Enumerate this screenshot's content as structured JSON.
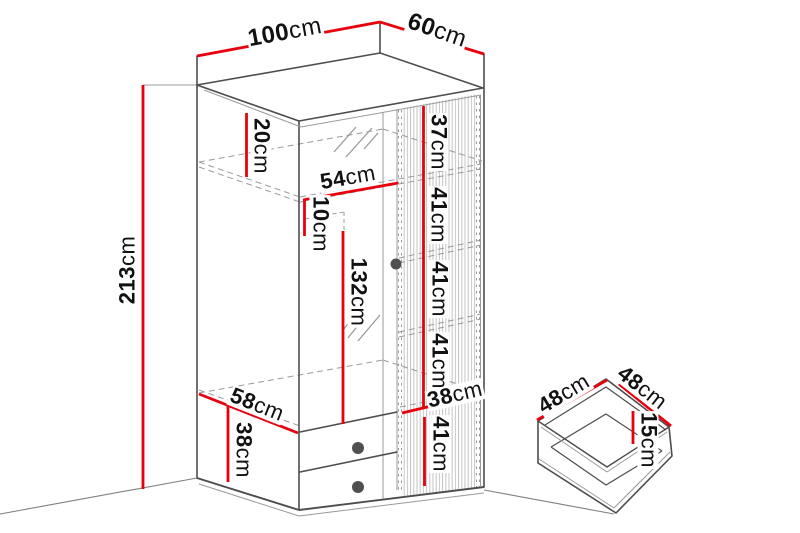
{
  "unit": "cm",
  "colors": {
    "dimension": "#e8000d",
    "outline": "#4d4d4d",
    "soft": "#9a9a9a",
    "dashed": "#999999",
    "holes": "#8f8f8f",
    "floor": "#808080",
    "slat": "#c4c4c4",
    "knob": "#4f4f4f",
    "text": "#111111"
  },
  "wardrobe": {
    "width_cm": 100,
    "depth_cm": 60,
    "height_cm": 213,
    "top_shelf_offset_cm": 20,
    "left_section_width_cm": 54,
    "rail_offset_cm": 10,
    "hanging_height_cm": 132,
    "right_shelf_spacing_cm": [
      37,
      41,
      41,
      41,
      41
    ],
    "right_section_width_cm": 38,
    "bottom_shelf_depth_cm": 58,
    "drawer_section_height_cm": 38
  },
  "drawer": {
    "width_cm": 48,
    "depth_cm": 48,
    "height_cm": 15
  },
  "labels": [
    {
      "id": "width",
      "value": "100",
      "unit": "cm"
    },
    {
      "id": "depth",
      "value": "60",
      "unit": "cm"
    },
    {
      "id": "height",
      "value": "213",
      "unit": "cm"
    },
    {
      "id": "top-shelf",
      "value": "20",
      "unit": "cm"
    },
    {
      "id": "left-width",
      "value": "54",
      "unit": "cm"
    },
    {
      "id": "rail-offset",
      "value": "10",
      "unit": "cm"
    },
    {
      "id": "hanging-height",
      "value": "132",
      "unit": "cm"
    },
    {
      "id": "shelf-1",
      "value": "37",
      "unit": "cm"
    },
    {
      "id": "shelf-2",
      "value": "41",
      "unit": "cm"
    },
    {
      "id": "shelf-3",
      "value": "41",
      "unit": "cm"
    },
    {
      "id": "shelf-4",
      "value": "41",
      "unit": "cm"
    },
    {
      "id": "right-width",
      "value": "38",
      "unit": "cm"
    },
    {
      "id": "shelf-5",
      "value": "41",
      "unit": "cm"
    },
    {
      "id": "bottom-depth",
      "value": "58",
      "unit": "cm"
    },
    {
      "id": "drawer-zone",
      "value": "38",
      "unit": "cm"
    },
    {
      "id": "drawer-width",
      "value": "48",
      "unit": "cm"
    },
    {
      "id": "drawer-depth",
      "value": "48",
      "unit": "cm"
    },
    {
      "id": "drawer-height",
      "value": "15",
      "unit": "cm"
    }
  ]
}
